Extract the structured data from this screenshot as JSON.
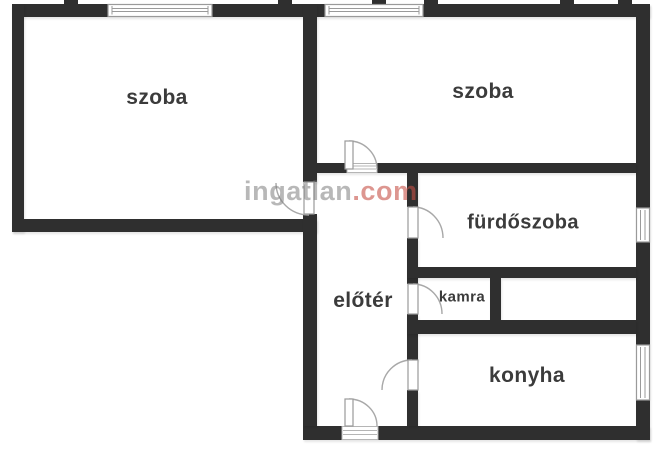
{
  "watermark": {
    "brand": "ingatlan",
    "suffix": ".com"
  },
  "rooms": {
    "room_left": "szoba",
    "room_right": "szoba",
    "bathroom": "fürdőszoba",
    "hall": "előtér",
    "pantry": "kamra",
    "kitchen": "konyha"
  },
  "colors": {
    "wall": "#2f2f2f",
    "floor": "#ffffff",
    "outline": "#a8a8a8",
    "label": "#3b3b3b",
    "wm-gray": "rgba(125,125,125,0.55)",
    "wm-red": "rgba(198,80,70,0.6)"
  }
}
